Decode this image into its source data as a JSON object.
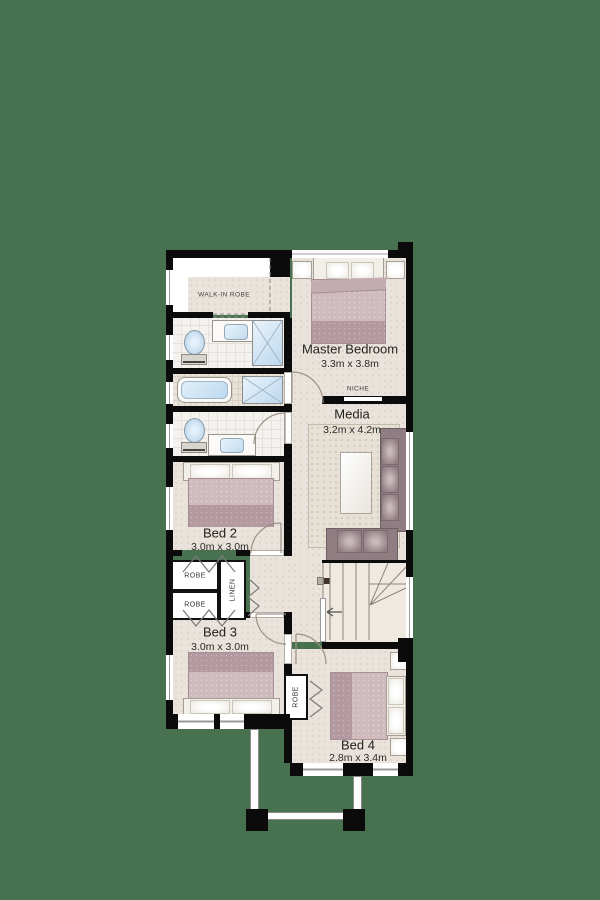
{
  "plan": {
    "rooms": {
      "walk_in_robe": {
        "name": "WALK-IN ROBE"
      },
      "master_bedroom": {
        "name": "Master Bedroom",
        "dims": "3.3m x 3.8m"
      },
      "media": {
        "name": "Media",
        "dims": "3.2m x 4.2m"
      },
      "bed2": {
        "name": "Bed 2",
        "dims": "3.0m x 3.0m"
      },
      "bed3": {
        "name": "Bed 3",
        "dims": "3.0m x 3.0m"
      },
      "bed4": {
        "name": "Bed 4",
        "dims": "2.8m x 3.4m"
      }
    },
    "closets": {
      "robe_bed2": {
        "name": "ROBE"
      },
      "robe_bed3": {
        "name": "ROBE"
      },
      "linen": {
        "name": "LINEN"
      },
      "robe_bed4": {
        "name": "ROBE"
      },
      "niche": {
        "name": "NICHE"
      }
    },
    "fixtures": {
      "master_bedroom": [
        "double-bed",
        "bedside-table",
        "bedside-table"
      ],
      "ensuite": [
        "toilet",
        "vanity-basin",
        "shower"
      ],
      "bathroom_mid": [
        "bathtub",
        "shower"
      ],
      "bathroom_lower": [
        "toilet",
        "vanity-basin"
      ],
      "media": [
        "rug",
        "coffee-table",
        "three-seat-sofa",
        "two-seat-sofa"
      ],
      "bed2": [
        "double-bed"
      ],
      "bed3": [
        "double-bed"
      ],
      "bed4": [
        "double-bed",
        "bedside-table",
        "bedside-table"
      ],
      "circulation": [
        "staircase",
        "down-arrow"
      ],
      "outdoor": [
        "balcony-posts",
        "balcony-beams"
      ]
    }
  },
  "colors": {
    "background": "#48724F",
    "wall": "#0B0B0B",
    "floor": "#EAE3DB",
    "tile": "#F4F2EE",
    "rug": "#E6E1D4",
    "bed": "#CFBABD",
    "bed_foot": "#B49AA0",
    "sofa": "#8F7D82",
    "water": "#BCD9EF",
    "window": "#FFFFFF"
  }
}
